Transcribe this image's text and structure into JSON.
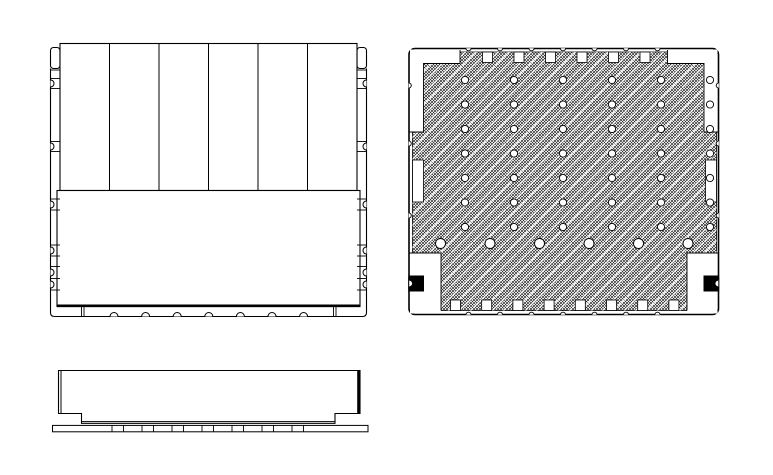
{
  "page": {
    "kind": "cad-technical-drawing",
    "colors": {
      "line": "#000000",
      "background": "#ffffff",
      "hatch": "#000000",
      "polarity_mark": "#000000",
      "pad_fill": "#ffffff"
    },
    "view_count": 3
  },
  "views": {
    "front": {
      "label": "front-view",
      "fin_count": 6,
      "shapes": [
        {
          "el": "path",
          "name": "outer-frame",
          "attrs": {
            "d": "M50.5,68.5 V312.5 Q50.5,316.5 54.5,316.5 H362.5 Q366.5,316.5 366.5,312.5 V68.5",
            "fill": "none",
            "stroke": "#000",
            "stroke-width": 1.1
          }
        },
        {
          "el": "rect",
          "name": "mount-tab-left",
          "attrs": {
            "x": 50.5,
            "y": 47.5,
            "width": 9.5,
            "height": 21,
            "rx": 3,
            "fill": "#fff",
            "stroke": "#000",
            "stroke-width": 1.1
          }
        },
        {
          "el": "rect",
          "name": "mount-tab-right",
          "attrs": {
            "x": 357,
            "y": 47.5,
            "width": 9.5,
            "height": 21,
            "rx": 3,
            "fill": "#fff",
            "stroke": "#000",
            "stroke-width": 1.1
          }
        },
        {
          "el": "rect",
          "name": "fin-panel-body",
          "attrs": {
            "x": 60,
            "y": 43.5,
            "width": 297,
            "height": 147,
            "fill": "#fff",
            "stroke": "#000",
            "stroke-width": 1.1
          }
        },
        {
          "el": "line",
          "name": "fin-divider",
          "attrs": {
            "x1": 109.5,
            "y1": 43.5,
            "x2": 109.5,
            "y2": 190.5,
            "stroke": "#000",
            "stroke-width": 1
          },
          "grid": {
            "cols": 5,
            "dx": 49.5
          }
        },
        {
          "el": "rect",
          "name": "label-plate",
          "attrs": {
            "x": 57,
            "y": 190.5,
            "width": 303,
            "height": 116,
            "fill": "#fff",
            "stroke": "#000",
            "stroke-width": 1.1
          }
        },
        {
          "el": "line",
          "name": "base-thick-line",
          "attrs": {
            "x1": 57,
            "y1": 305.8,
            "x2": 360,
            "y2": 305.8,
            "stroke": "#000",
            "stroke-width": 2.6
          }
        },
        {
          "el": "line",
          "name": "edge-tick-left",
          "attrs": {
            "x1": 50.5,
            "y1": 0,
            "x2": 60,
            "y2": 0,
            "stroke": "#000",
            "stroke-width": 0.9
          },
          "at": [
            [
              0,
              70
            ],
            [
              0,
              78.5
            ],
            [
              0,
              88.5
            ],
            [
              0,
              141.5
            ],
            [
              0,
              151.5
            ],
            [
              0,
              199
            ],
            [
              0,
              210
            ],
            [
              0,
              245
            ],
            [
              0,
              256
            ],
            [
              0,
              266.5
            ],
            [
              0,
              278.5
            ],
            [
              0,
              290
            ]
          ]
        },
        {
          "el": "line",
          "name": "edge-tick-right",
          "attrs": {
            "x1": 357,
            "y1": 0,
            "x2": 366.5,
            "y2": 0,
            "stroke": "#000",
            "stroke-width": 0.9
          },
          "at": [
            [
              0,
              70
            ],
            [
              0,
              78.5
            ],
            [
              0,
              88.5
            ],
            [
              0,
              141.5
            ],
            [
              0,
              151.5
            ],
            [
              0,
              199
            ],
            [
              0,
              210
            ],
            [
              0,
              245
            ],
            [
              0,
              256
            ],
            [
              0,
              266.5
            ],
            [
              0,
              278.5
            ],
            [
              0,
              290
            ]
          ]
        },
        {
          "el": "path",
          "name": "edge-notch-left",
          "attrs": {
            "d": "M0,-3.5 A3.5,3.5 0 0 1 0,3.5",
            "fill": "#fff",
            "stroke": "#000",
            "stroke-width": 1
          },
          "at": [
            [
              50.5,
              83.5
            ],
            [
              50.5,
              146.5
            ],
            [
              50.5,
              204.5
            ],
            [
              50.5,
              250.5
            ],
            [
              50.5,
              272.5
            ],
            [
              50.5,
              284.5
            ]
          ]
        },
        {
          "el": "path",
          "name": "edge-notch-right",
          "attrs": {
            "d": "M0,-3.5 A3.5,3.5 0 0 0 0,3.5",
            "fill": "#fff",
            "stroke": "#000",
            "stroke-width": 1
          },
          "at": [
            [
              366.5,
              83.5
            ],
            [
              366.5,
              146.5
            ],
            [
              366.5,
              204.5
            ],
            [
              366.5,
              250.5
            ],
            [
              366.5,
              272.5
            ],
            [
              366.5,
              284.5
            ]
          ]
        },
        {
          "el": "path",
          "name": "bottom-bump",
          "attrs": {
            "d": "M-4,0 A4,4 0 0 1 4,0",
            "fill": "#fff",
            "stroke": "#000",
            "stroke-width": 1
          },
          "at": [
            [
              114,
              316.5
            ],
            [
              145.6,
              316.5
            ],
            [
              177.2,
              316.5
            ],
            [
              208.8,
              316.5
            ],
            [
              240.4,
              316.5
            ],
            [
              272,
              316.5
            ],
            [
              303.6,
              316.5
            ]
          ]
        },
        {
          "el": "line",
          "name": "bottom-strip-tick",
          "attrs": {
            "x1": 0,
            "y1": 306.5,
            "x2": 0,
            "y2": 316.5,
            "stroke": "#000",
            "stroke-width": 0.9
          },
          "at": [
            [
              81.5,
              0
            ],
            [
              84,
              0
            ],
            [
              333.5,
              0
            ],
            [
              336,
              0
            ]
          ]
        }
      ]
    },
    "bottom": {
      "label": "bottom-view",
      "via_rows": 7,
      "via_cols": 6,
      "shapes": [
        {
          "el": "rect",
          "name": "outline",
          "attrs": {
            "x": 409,
            "y": 48.5,
            "width": 309.5,
            "height": 266,
            "rx": 6,
            "fill": "#fff",
            "stroke": "#000",
            "stroke-width": 1.6
          }
        },
        {
          "el": "rect",
          "name": "hatch-fill",
          "attrs": {
            "x": 412.5,
            "y": 52,
            "width": 304,
            "height": 258.5,
            "fill": "url(#hatch)",
            "stroke": "#000",
            "stroke-width": 0.8
          }
        },
        {
          "el": "rect",
          "name": "hatch-streaks",
          "attrs": {
            "x": 412.5,
            "y": 52,
            "width": 304,
            "height": 258.5,
            "fill": "url(#streaks)",
            "stroke": "none"
          }
        },
        {
          "el": "path",
          "name": "corner-cutout-tl",
          "attrs": {
            "d": "M410,49.5 H460 V63.5 H423.5 V132 H410 Z",
            "fill": "#fff",
            "stroke": "none"
          }
        },
        {
          "el": "path",
          "name": "corner-boundary-tl",
          "attrs": {
            "d": "M460,50 V63.5 H423.5 V132 H409.5",
            "fill": "none",
            "stroke": "#000",
            "stroke-width": 0.9
          }
        },
        {
          "el": "path",
          "name": "corner-cutout-tr",
          "attrs": {
            "d": "M717.5,49.5 H667.5 V63.5 H704 V132 H717.5 Z",
            "fill": "#fff",
            "stroke": "none"
          }
        },
        {
          "el": "path",
          "name": "corner-boundary-tr",
          "attrs": {
            "d": "M667.5,50 V63.5 H704 V132 H718",
            "fill": "none",
            "stroke": "#000",
            "stroke-width": 0.9
          }
        },
        {
          "el": "path",
          "name": "corner-cutout-bl",
          "attrs": {
            "d": "M410,253 H441 V313.5 H410 Z",
            "fill": "#fff",
            "stroke": "none"
          }
        },
        {
          "el": "path",
          "name": "corner-boundary-bl",
          "attrs": {
            "d": "M409.5,253 H441 V310.5",
            "fill": "none",
            "stroke": "#000",
            "stroke-width": 0.9
          }
        },
        {
          "el": "path",
          "name": "corner-cutout-br",
          "attrs": {
            "d": "M717.5,253 H687 V313.5 H717.5 Z",
            "fill": "#fff",
            "stroke": "none"
          }
        },
        {
          "el": "path",
          "name": "corner-boundary-br",
          "attrs": {
            "d": "M718,253 H687 V310.5",
            "fill": "none",
            "stroke": "#000",
            "stroke-width": 0.9
          }
        },
        {
          "el": "rect",
          "name": "top-pad",
          "attrs": {
            "x": 482.5,
            "y": 52,
            "width": 10,
            "height": 10.5,
            "fill": "#fff",
            "stroke": "#000",
            "stroke-width": 0.8
          },
          "grid": {
            "cols": 6,
            "dx": 31.5
          }
        },
        {
          "el": "rect",
          "name": "bottom-pad",
          "attrs": {
            "x": 450.5,
            "y": 300,
            "width": 10,
            "height": 10.5,
            "fill": "#fff",
            "stroke": "#000",
            "stroke-width": 0.8
          },
          "grid": {
            "cols": 8,
            "dx": 31.2
          }
        },
        {
          "el": "rect",
          "name": "side-pad-left",
          "attrs": {
            "x": 412.5,
            "y": 160,
            "width": 11,
            "height": 42,
            "fill": "#fff",
            "stroke": "#000",
            "stroke-width": 0.8
          }
        },
        {
          "el": "rect",
          "name": "side-pad-right",
          "attrs": {
            "x": 705.5,
            "y": 160,
            "width": 11,
            "height": 42,
            "fill": "#fff",
            "stroke": "#000",
            "stroke-width": 0.8
          }
        },
        {
          "el": "circle",
          "name": "via-dot",
          "attrs": {
            "cx": 465,
            "cy": 80,
            "r": 3.6,
            "fill": "#fff",
            "stroke": "#000",
            "stroke-width": 0.9
          },
          "grid": {
            "cols": 6,
            "dx": 49,
            "rows": 7,
            "dy": 24.5
          }
        },
        {
          "el": "circle",
          "name": "via-dot-large",
          "attrs": {
            "cx": 440.5,
            "cy": 243.5,
            "r": 5,
            "fill": "#fff",
            "stroke": "#000",
            "stroke-width": 0.9
          },
          "grid": {
            "cols": 6,
            "dx": 49.5
          }
        },
        {
          "el": "rect",
          "name": "polarity-mark-left",
          "attrs": {
            "x": 408.3,
            "y": 275.5,
            "width": 15.7,
            "height": 16,
            "fill": "#000",
            "stroke": "none"
          }
        },
        {
          "el": "path",
          "name": "polarity-notch-left",
          "attrs": {
            "d": "M0,-3.4 A3.4,3.4 0 0 1 0,3.4",
            "fill": "#fff",
            "stroke": "#000",
            "stroke-width": 1,
            "transform": "translate(409.2,283.5)"
          }
        },
        {
          "el": "rect",
          "name": "polarity-mark-right",
          "attrs": {
            "x": 703.5,
            "y": 275.5,
            "width": 15.7,
            "height": 16,
            "fill": "#000",
            "stroke": "none"
          }
        },
        {
          "el": "path",
          "name": "polarity-notch-right",
          "attrs": {
            "d": "M0,-3.4 A3.4,3.4 0 0 0 0,3.4",
            "fill": "#fff",
            "stroke": "#000",
            "stroke-width": 1,
            "transform": "translate(718.3,283.5)"
          }
        },
        {
          "el": "path",
          "name": "border-notch-top",
          "attrs": {
            "d": "M-2.6,0 A2.6,2.6 0 0 0 2.6,0",
            "fill": "#fff",
            "stroke": "#000",
            "stroke-width": 0.9,
            "transform": "translate(468.5,48.2)"
          },
          "grid": {
            "cols": 7,
            "dx": 31.5
          }
        },
        {
          "el": "path",
          "name": "border-notch-bottom",
          "attrs": {
            "d": "M-2.6,0 A2.6,2.6 0 0 1 2.6,0",
            "fill": "#fff",
            "stroke": "#000",
            "stroke-width": 0.9,
            "transform": "translate(468.5,314.8)"
          },
          "grid": {
            "cols": 7,
            "dx": 31.5
          }
        },
        {
          "el": "path",
          "name": "border-notch-left",
          "attrs": {
            "d": "M0,-2.6 A2.6,2.6 0 0 1 0,2.6",
            "fill": "#fff",
            "stroke": "#000",
            "stroke-width": 0.9
          },
          "at": [
            [
              408.7,
              85.5
            ],
            [
              408.7,
              143.5
            ],
            [
              408.7,
              215.5
            ]
          ]
        },
        {
          "el": "path",
          "name": "border-notch-right",
          "attrs": {
            "d": "M0,-2.6 A2.6,2.6 0 0 0 0,2.6",
            "fill": "#fff",
            "stroke": "#000",
            "stroke-width": 0.9
          },
          "at": [
            [
              718.8,
              85.5
            ],
            [
              718.8,
              143.5
            ],
            [
              718.8,
              215.5
            ]
          ]
        }
      ]
    },
    "side": {
      "label": "side-view",
      "shapes": [
        {
          "el": "path",
          "name": "body-outline",
          "attrs": {
            "d": "M58.5,370.5 V413.5 H81.5 V423.3 H335 V413.5 H360 V370.5 Z",
            "fill": "#fff",
            "stroke": "#000",
            "stroke-width": 1.1
          }
        },
        {
          "el": "line",
          "name": "body-inner-edge-left",
          "attrs": {
            "x1": 61,
            "y1": 370.5,
            "x2": 61,
            "y2": 413.5,
            "stroke": "#000",
            "stroke-width": 1
          }
        },
        {
          "el": "line",
          "name": "body-right-edge",
          "attrs": {
            "x1": 358.6,
            "y1": 370.5,
            "x2": 358.6,
            "y2": 413.5,
            "stroke": "#000",
            "stroke-width": 2.8
          }
        },
        {
          "el": "line",
          "name": "body-bottom-inner",
          "attrs": {
            "x1": 81.5,
            "y1": 421.6,
            "x2": 335,
            "y2": 421.6,
            "stroke": "#000",
            "stroke-width": 0.9
          }
        },
        {
          "el": "rect",
          "name": "pcb-strip",
          "attrs": {
            "x": 52.5,
            "y": 425.4,
            "width": 315.5,
            "height": 6.4,
            "fill": "#fff",
            "stroke": "#000",
            "stroke-width": 1
          }
        },
        {
          "el": "line",
          "name": "pcb-pad-tick",
          "attrs": {
            "x1": 0,
            "y1": 425.4,
            "x2": 0,
            "y2": 431.8,
            "stroke": "#000",
            "stroke-width": 0.9
          },
          "at": [
            [
              112,
              0
            ],
            [
              123.5,
              0
            ],
            [
              142,
              0
            ],
            [
              153.5,
              0
            ],
            [
              172,
              0
            ],
            [
              183.5,
              0
            ],
            [
              202,
              0
            ],
            [
              213.5,
              0
            ],
            [
              232,
              0
            ],
            [
              243.5,
              0
            ],
            [
              262,
              0
            ],
            [
              273.5,
              0
            ],
            [
              292,
              0
            ],
            [
              303.5,
              0
            ]
          ]
        }
      ]
    }
  }
}
